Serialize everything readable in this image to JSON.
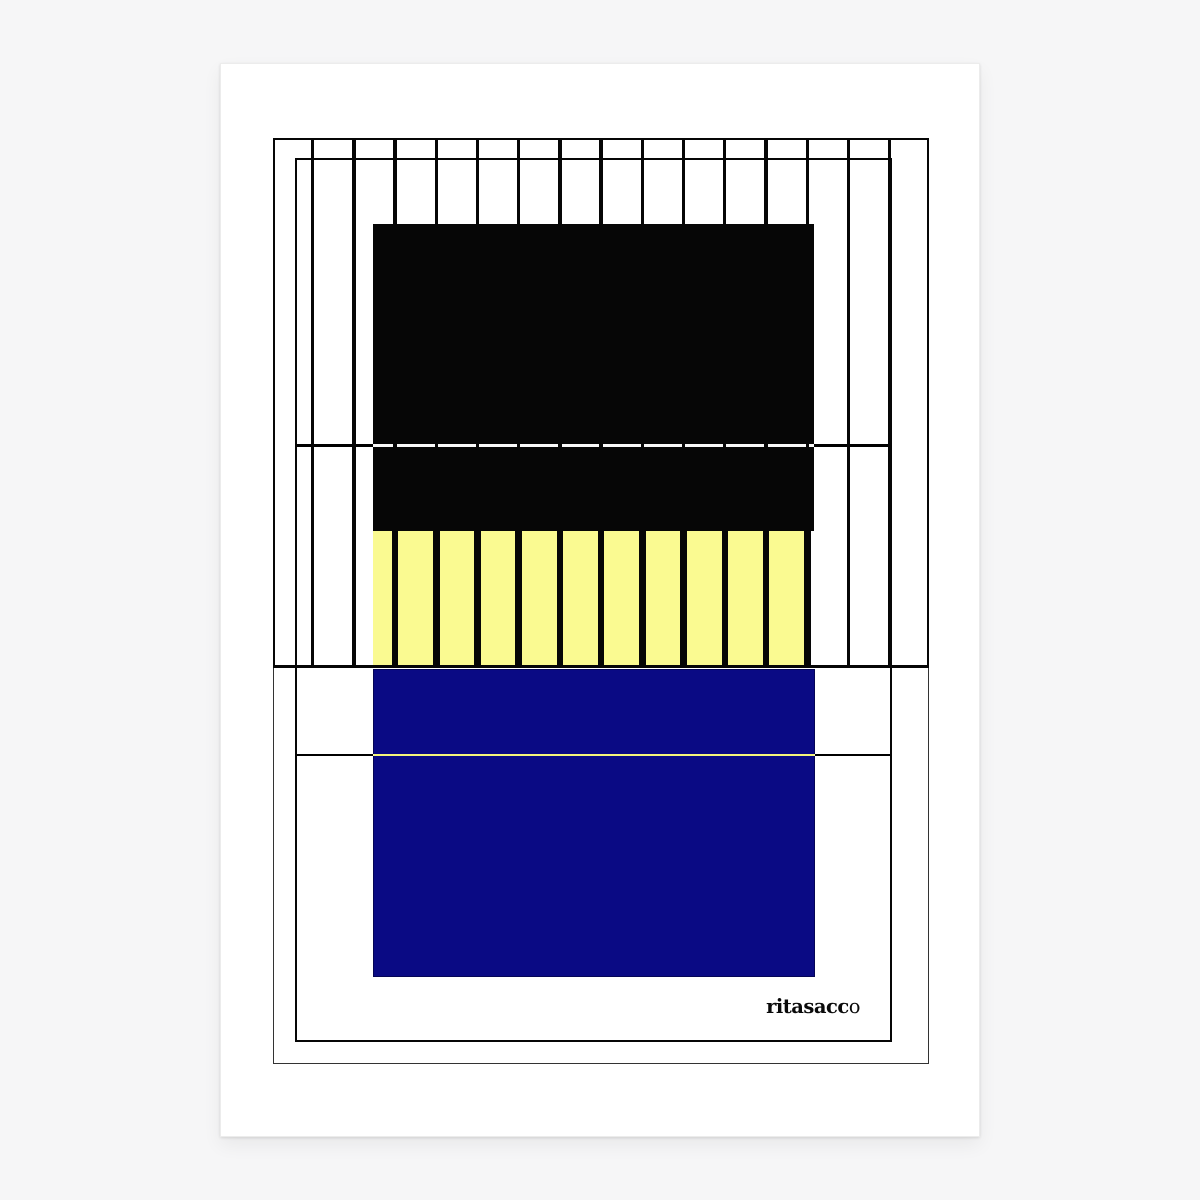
{
  "artwork": {
    "signature": {
      "text": "ritasacco",
      "main": "ritasacc",
      "last_char": "o"
    }
  },
  "colors": {
    "page_bg": "#f6f6f7",
    "sheet": "#ffffff",
    "ink": "#060606",
    "frame_thin": "#333333",
    "yellow": "#fafa91",
    "blue": "#0a0a84"
  },
  "stripes": {
    "count": 15
  },
  "yellow_bars": {
    "count": 11,
    "first_index": 2
  }
}
